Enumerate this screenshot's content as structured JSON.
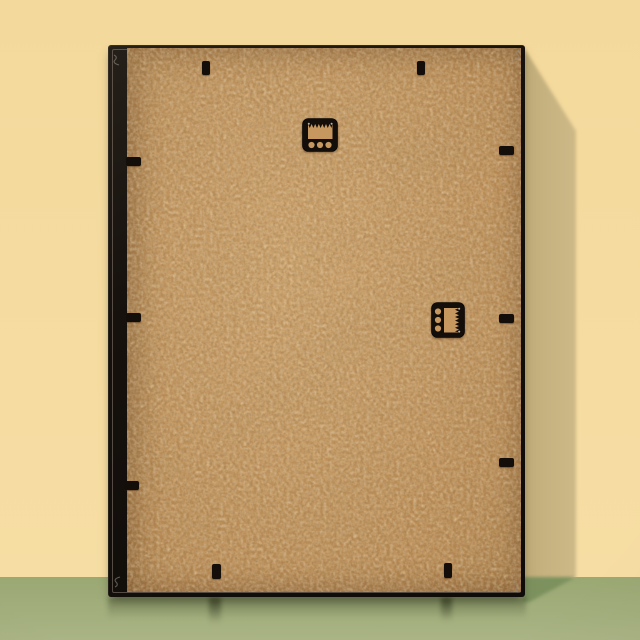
{
  "scene": {
    "title": "Back view of a black picture frame with kraft MDF backing board, two sawtooth hangers and retainer tabs, leaning against a pale yellow wall on a green floor"
  },
  "colors": {
    "wall": "#f4d99c",
    "wall_shadow": "#c6b27f",
    "floor_top": "#9aa873",
    "floor_bottom": "#aab485",
    "floor_shadow": "#7c915e",
    "frame": "#16110d",
    "frame_bevel": "#8a8074",
    "recess": "#6e4120",
    "recess_dark": "#2a160a",
    "backing": "#c6975e",
    "backing_light": "#d2a56c",
    "backing_dark": "#a87a43",
    "hardware": "#130e0a",
    "glint": "#d8d0c4",
    "corner_mark": "#968c82"
  },
  "objects": {
    "frame_back": {
      "label": "picture frame, back side, black moulding"
    },
    "backing_board": {
      "label": "tan MDF backing board"
    },
    "hangers": [
      {
        "id": "sawtooth-hanger-top",
        "label": "sawtooth hanger, horizontal (portrait hanging)",
        "screw_holes": 3
      },
      {
        "id": "sawtooth-hanger-side",
        "label": "sawtooth hanger, vertical (landscape hanging)",
        "screw_holes": 3
      }
    ],
    "retainer_tabs": {
      "label": "black backing retainer tabs",
      "count": 10,
      "top": 2,
      "right": 3,
      "bottom": 2,
      "left": 3
    },
    "corner_marks": {
      "label": "mitre joint marks",
      "count": 4
    }
  }
}
